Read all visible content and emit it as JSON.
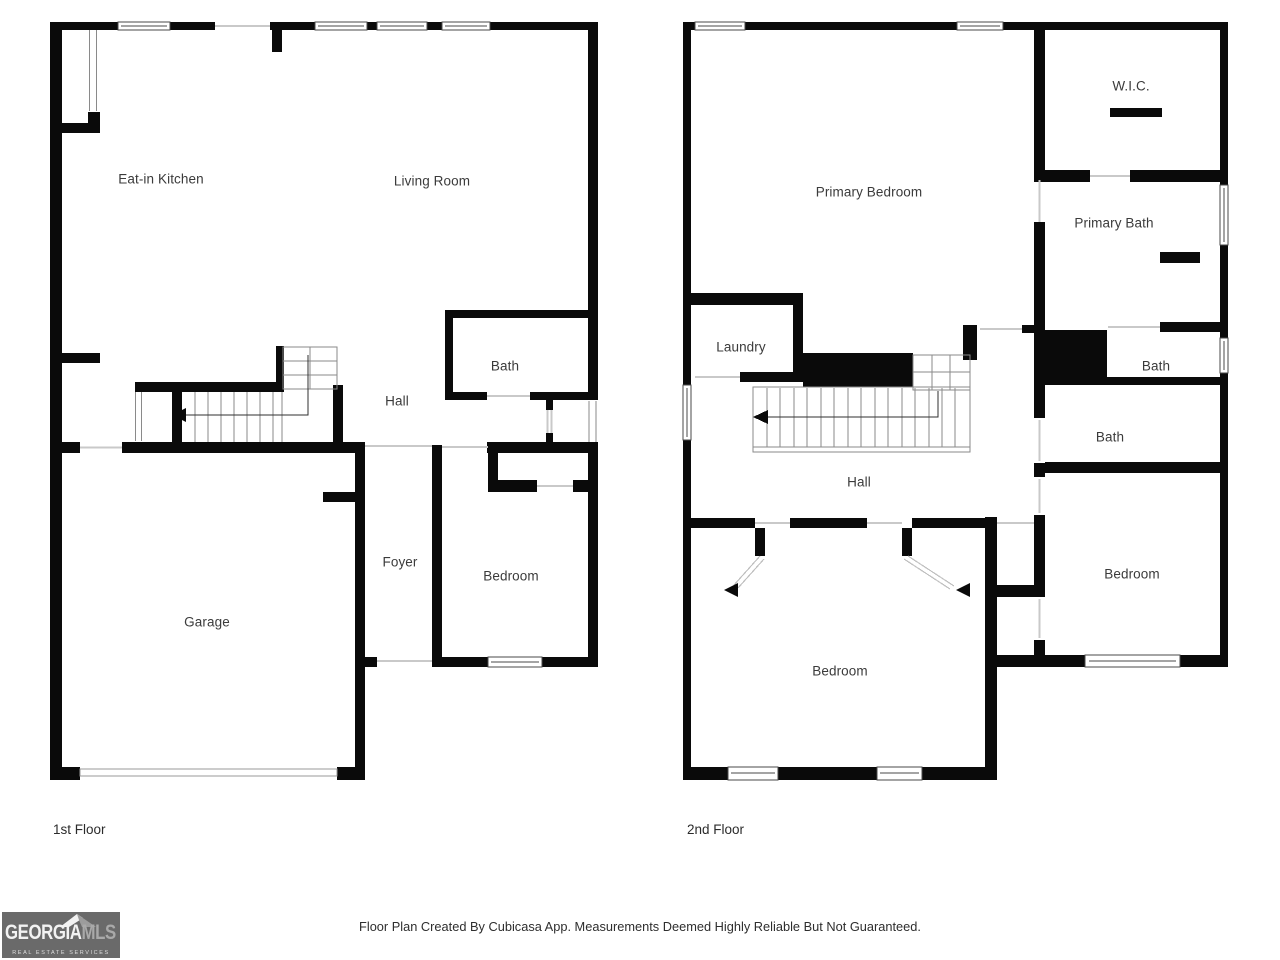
{
  "floors": [
    {
      "title": "1st Floor",
      "rooms": [
        {
          "name": "eat-in-kitchen",
          "label": "Eat-in Kitchen"
        },
        {
          "name": "living-room",
          "label": "Living Room"
        },
        {
          "name": "bath",
          "label": "Bath"
        },
        {
          "name": "hall",
          "label": "Hall"
        },
        {
          "name": "foyer",
          "label": "Foyer"
        },
        {
          "name": "bedroom",
          "label": "Bedroom"
        },
        {
          "name": "garage",
          "label": "Garage"
        }
      ]
    },
    {
      "title": "2nd Floor",
      "rooms": [
        {
          "name": "primary-bedroom",
          "label": "Primary Bedroom"
        },
        {
          "name": "walk-in-closet",
          "label": "W.I.C."
        },
        {
          "name": "primary-bath",
          "label": "Primary Bath"
        },
        {
          "name": "laundry",
          "label": "Laundry"
        },
        {
          "name": "bath-upper",
          "label": "Bath"
        },
        {
          "name": "bath-lower",
          "label": "Bath"
        },
        {
          "name": "hall",
          "label": "Hall"
        },
        {
          "name": "bedroom-east",
          "label": "Bedroom"
        },
        {
          "name": "bedroom-south",
          "label": "Bedroom"
        }
      ]
    }
  ],
  "footer": {
    "disclaimer": "Floor Plan Created By Cubicasa App. Measurements Deemed Highly Reliable But Not Guaranteed."
  },
  "logo": {
    "brand_primary": "GEORGIA",
    "brand_secondary": "MLS",
    "tagline": "REAL ESTATE SERVICES"
  },
  "colors": {
    "wall": "#0a0a0a",
    "background": "#ffffff",
    "label_text": "#3b3b3b",
    "logo_background": "#6a6a6a"
  }
}
